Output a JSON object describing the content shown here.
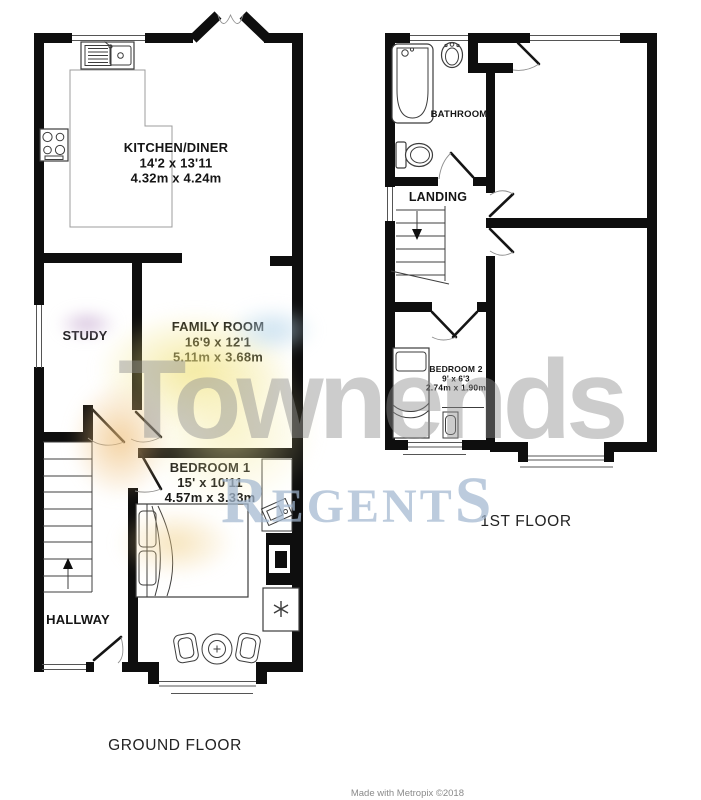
{
  "image": {
    "width": 701,
    "height": 800,
    "background": "#ffffff"
  },
  "plans": {
    "ground_floor": {
      "caption": "GROUND FLOOR",
      "rooms": {
        "kitchen_diner": {
          "name": "KITCHEN/DINER",
          "imperial": "14'2 x 13'11",
          "metric": "4.32m x 4.24m"
        },
        "study": {
          "name": "STUDY"
        },
        "family_room": {
          "name": "FAMILY ROOM",
          "imperial": "16'9 x 12'1",
          "metric": "5.11m x 3.68m"
        },
        "bedroom_1": {
          "name": "BEDROOM 1",
          "imperial": "15' x 10'11",
          "metric": "4.57m x 3.33m"
        },
        "hallway": {
          "name": "HALLWAY"
        }
      }
    },
    "first_floor": {
      "caption": "1ST FLOOR",
      "rooms": {
        "bathroom": {
          "name": "BATHROOM"
        },
        "landing": {
          "name": "LANDING"
        },
        "bedroom_2": {
          "name": "BEDROOM 2",
          "imperial": "9' x 6'3",
          "metric": "2.74m x 1.90m"
        }
      }
    }
  },
  "watermark": {
    "brand": "Townends",
    "agency_first": "R",
    "agency_mid": "EGENT",
    "agency_last": "S",
    "brand_color": "#c8c8c8",
    "agency_color": "#a3b8d0",
    "swoosh_yellow": "#f0e178",
    "swoosh_orange": "#eec27e",
    "swoosh_purple": "#c9aed3",
    "swoosh_blue": "#b9d7eb"
  },
  "footer": {
    "credit": "Made with Metropix ©2018"
  }
}
